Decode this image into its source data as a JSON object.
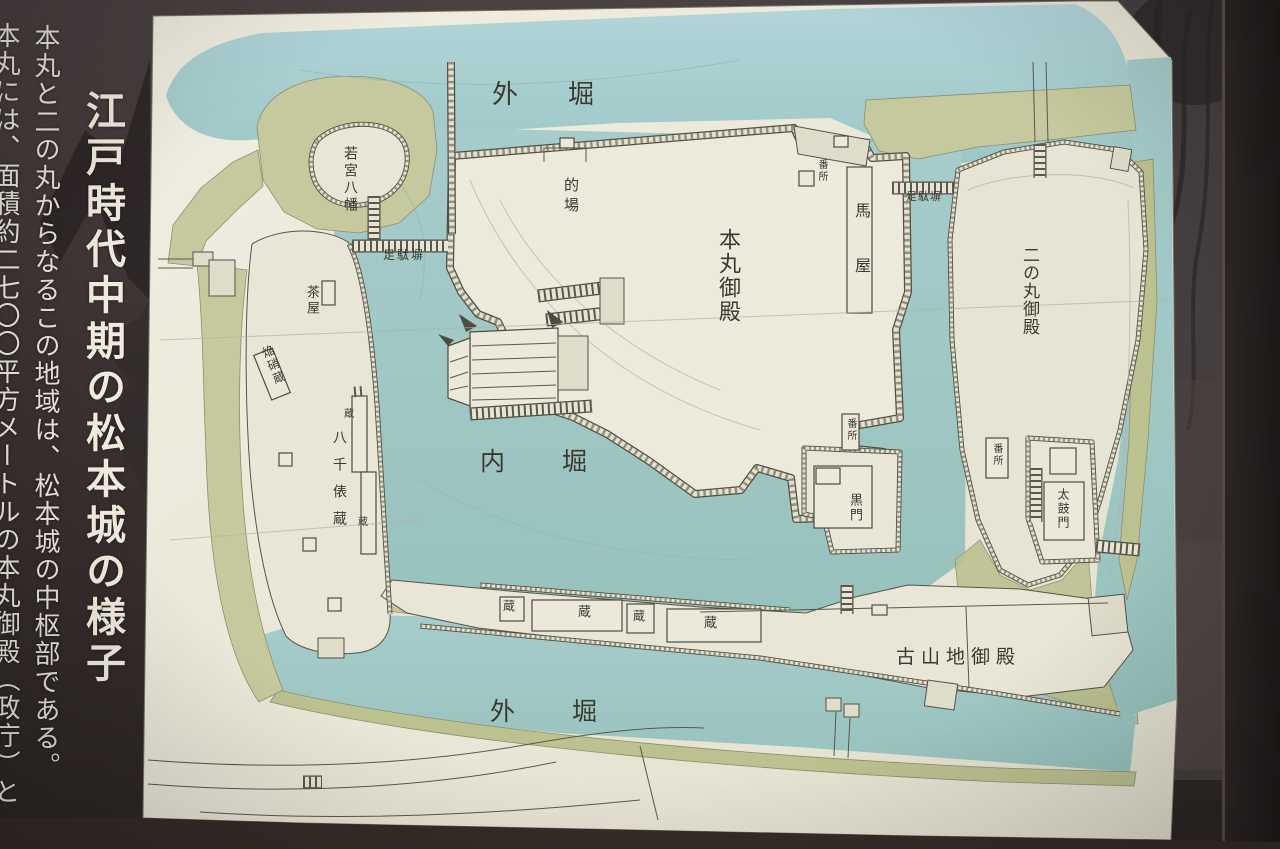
{
  "sign": {
    "title": "江戸時代中期の松本城の様子",
    "body_columns": [
      "本丸と二の丸からなるこの地域は、松本城の中枢部である。",
      "本丸には、面積約二七〇〇平方メートルの本丸御殿（政庁）と"
    ]
  },
  "map": {
    "labels": {
      "soto_bori_top": "外堀",
      "wakamiya_hachiman": "若宮八幡",
      "matoba": "的場",
      "bansho_top": "番所",
      "umaya": "馬屋",
      "honmaru_goten": "本丸御殿",
      "ashidabei_w": "足駄塀",
      "ashidabei_e": "足駄塀",
      "ninomaru_goten": "二の丸御殿",
      "uchi_bori": "内堀",
      "chaya": "茶屋",
      "ensho_gura": "焔硝蔵",
      "hassenpyo_gura": "八千俵蔵",
      "kura_small_1": "蔵",
      "kura_small_2": "蔵",
      "kura_a": "蔵",
      "kura_b": "蔵",
      "kura_c": "蔵",
      "kura_d": "蔵",
      "kuromon": "黒門",
      "bansho_kuromon": "番所",
      "bansho_e": "番所",
      "taikomon": "太鼓門",
      "koyamaji_goten": "古山地御殿",
      "soto_bori_bottom": "外堀"
    }
  },
  "colors": {
    "moat_blue": "#a7cdd0",
    "bank_olive": "#c6c99d",
    "paper_cream": "#ebe8da",
    "ink": "#4e4b41",
    "frame_brown": "#3a3231"
  }
}
